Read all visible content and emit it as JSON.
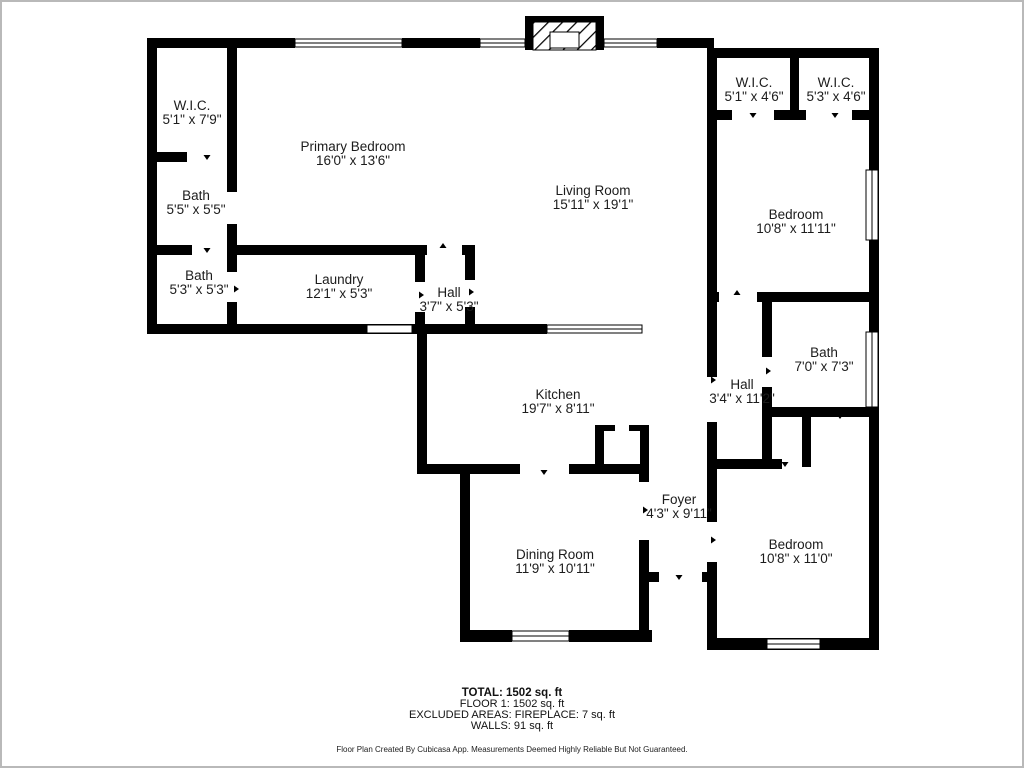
{
  "plan": {
    "colors": {
      "wall": "#000000",
      "floor": "#ffffff",
      "label": "#1c1c1c",
      "frame": "#b9b9b9"
    },
    "rooms": [
      {
        "name": "W.I.C.",
        "dims": "5'1\" x 7'9\"",
        "x": 190,
        "y": 111
      },
      {
        "name": "Primary Bedroom",
        "dims": "16'0\" x 13'6\"",
        "x": 351,
        "y": 152
      },
      {
        "name": "Bath",
        "dims": "5'5\" x 5'5\"",
        "x": 194,
        "y": 201
      },
      {
        "name": "Bath",
        "dims": "5'3\" x 5'3\"",
        "x": 197,
        "y": 281
      },
      {
        "name": "Laundry",
        "dims": "12'1\" x 5'3\"",
        "x": 337,
        "y": 285
      },
      {
        "name": "Hall",
        "dims": "3'7\" x 5'3\"",
        "x": 447,
        "y": 298
      },
      {
        "name": "Living Room",
        "dims": "15'11\" x 19'1\"",
        "x": 591,
        "y": 196
      },
      {
        "name": "W.I.C.",
        "dims": "5'1\" x 4'6\"",
        "x": 752,
        "y": 88
      },
      {
        "name": "W.I.C.",
        "dims": "5'3\" x 4'6\"",
        "x": 834,
        "y": 88
      },
      {
        "name": "Bedroom",
        "dims": "10'8\" x 11'11\"",
        "x": 794,
        "y": 220
      },
      {
        "name": "Bath",
        "dims": "7'0\" x 7'3\"",
        "x": 822,
        "y": 358
      },
      {
        "name": "Hall",
        "dims": "3'4\" x 11'2\"",
        "x": 740,
        "y": 390
      },
      {
        "name": "Kitchen",
        "dims": "19'7\" x 8'11\"",
        "x": 556,
        "y": 400
      },
      {
        "name": "Foyer",
        "dims": "4'3\" x 9'11\"",
        "x": 677,
        "y": 505
      },
      {
        "name": "Dining Room",
        "dims": "11'9\" x 10'11\"",
        "x": 553,
        "y": 560
      },
      {
        "name": "Bedroom",
        "dims": "10'8\" x 11'0\"",
        "x": 794,
        "y": 550
      }
    ]
  },
  "summary": {
    "total": "TOTAL: 1502 sq. ft",
    "floor": "FLOOR 1: 1502 sq. ft",
    "excluded": "EXCLUDED AREAS: FIREPLACE: 7 sq. ft",
    "walls": "WALLS: 91 sq. ft"
  },
  "disclaimer": "Floor Plan Created By Cubicasa App. Measurements Deemed Highly Reliable But Not Guaranteed."
}
